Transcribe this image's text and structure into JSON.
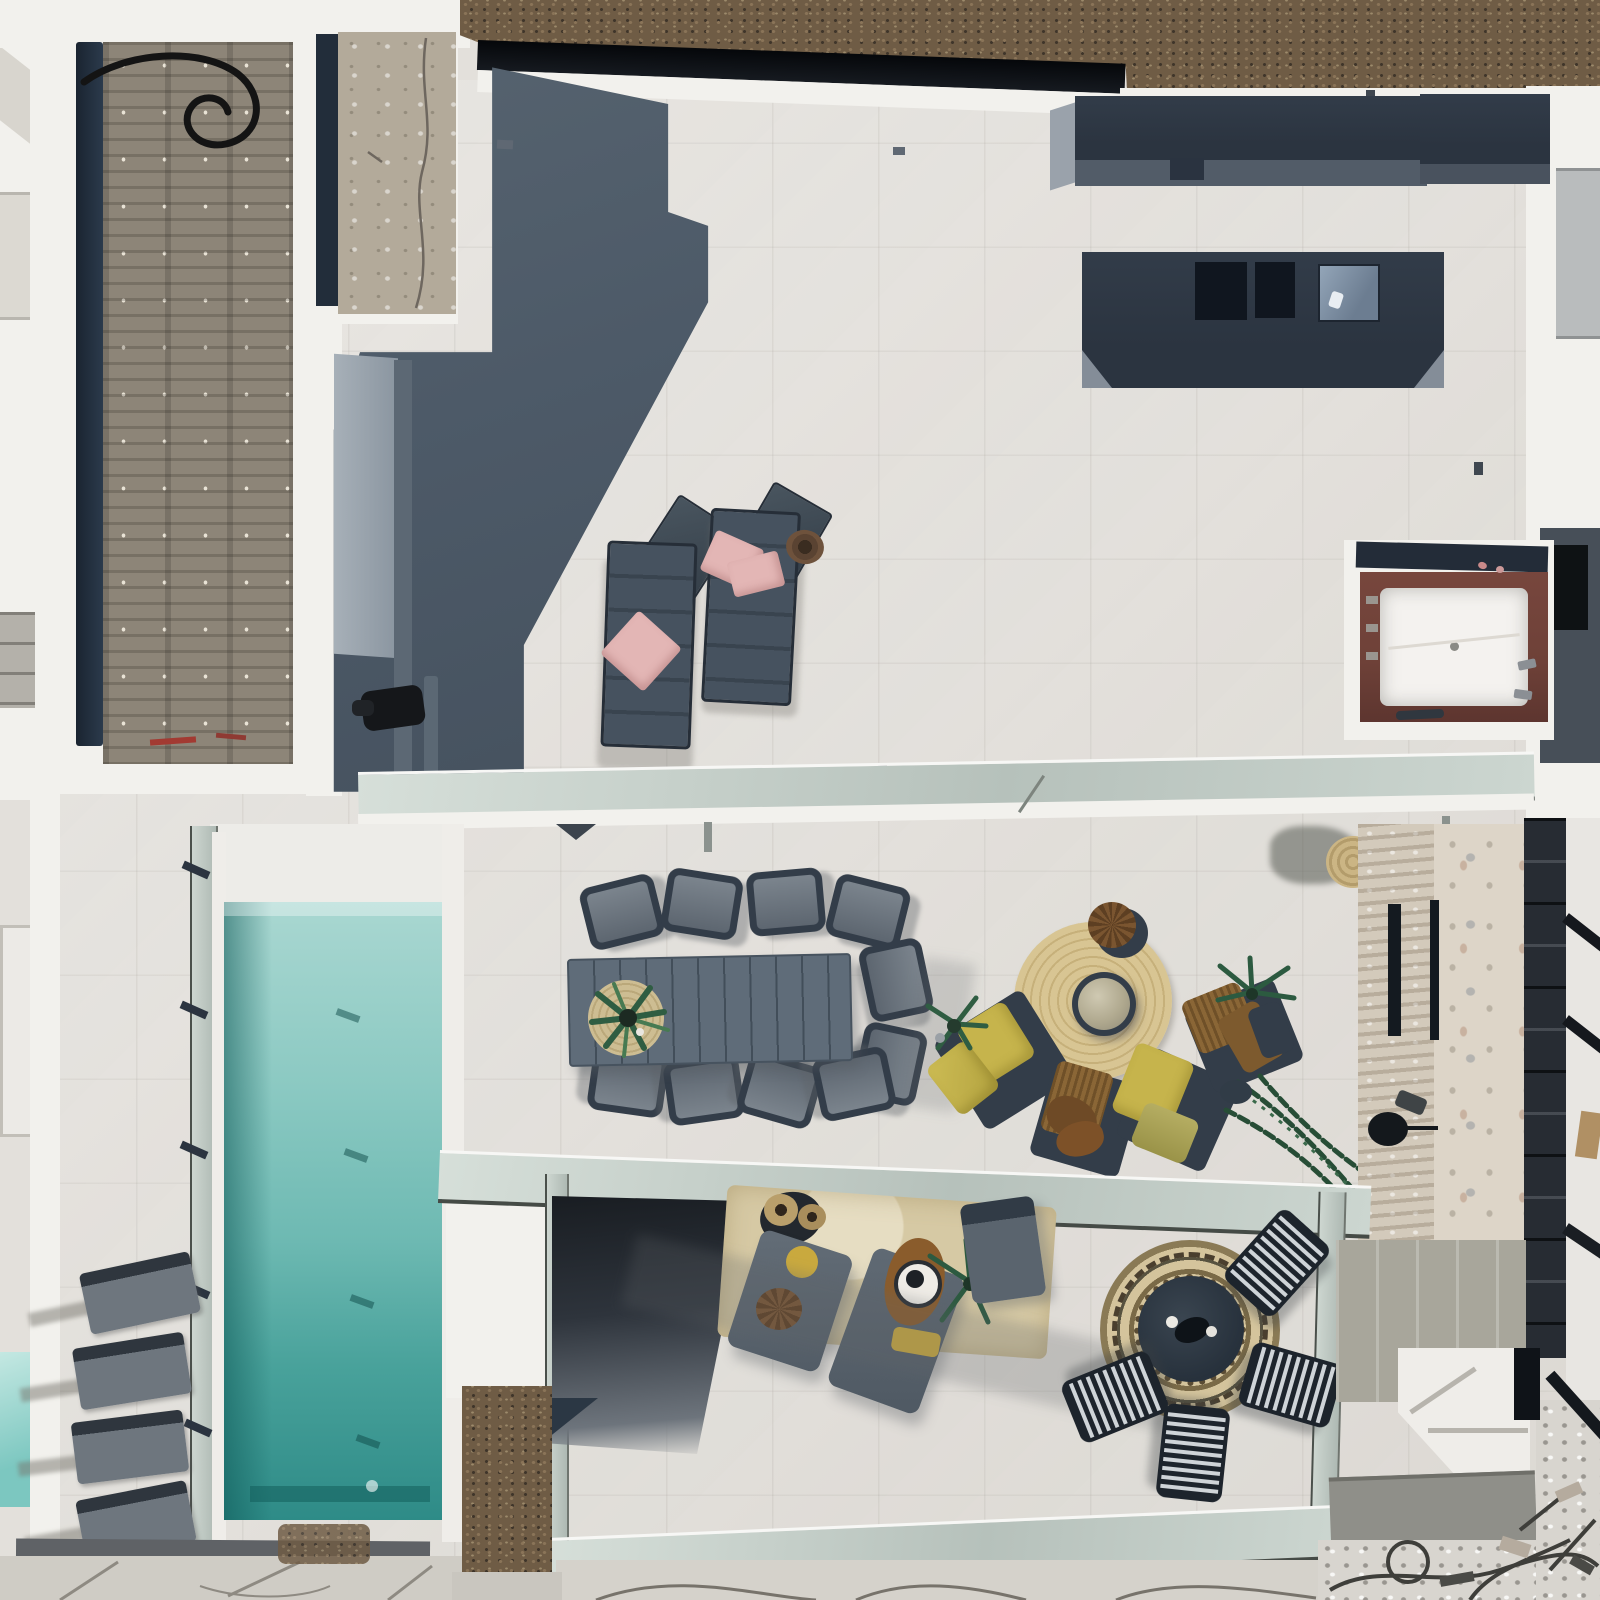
{
  "scene": {
    "type": "aerial-photo",
    "description": "Top-down drone view of a modern villa roof terrace: upper tiled deck with sun loungers and a wood-framed hot tub, dark roof boxes with skylights, a long turquoise lap pool with glass fencing, outdoor dining table, round jute rug lounge with yellow and wicker chairs, lower glass-walled patio with gray chaises and a mandala rug dining set, stone-clad wall with lamp, dark staircase and construction debris at the edges",
    "camera": "orthographic top-down",
    "colors": {
      "terrace-tile": "#e3e0db",
      "terrace-tile-shade": "#d7d4ce",
      "parapet-white": "#f2f1ed",
      "roof-felt": "#8d8578",
      "roof-felt-dark": "#6e675c",
      "navy-edge": "#212c3a",
      "concrete-beige": "#b3aa9a",
      "mulch": "#6f5c45",
      "mulch-dark": "#4e4232",
      "glass-band": "#c6d0ca",
      "glass-dark-rail": "#454b46",
      "slate-structure": "#4d5a68",
      "slate-light": "#95a0ab",
      "navy-box": "#2b3440",
      "navy-box-face": "#525c68",
      "skylight-blue": "#7d8fa3",
      "lounger-slate": "#414d5a",
      "pink-pillow": "#e3b6b5",
      "jacuzzi-wood": "#6e4138",
      "jacuzzi-tub": "#f4f2ef",
      "pool-light": "#a9d7d1",
      "pool-mid": "#6db9b2",
      "pool-deep": "#2e8b87",
      "pool-edge-dark": "#1f7a76",
      "gray-lounger": "#6e767e",
      "table-slat": "#5f6c79",
      "chair-navy": "#333d49",
      "jute": "#d8c593",
      "brass": "#b0a98f",
      "yellow-cushion": "#c6b44c",
      "wicker-brown": "#8a6636",
      "leather-brown": "#7a5330",
      "plant-green": "#3a6a4b",
      "plant-green-dark": "#274d36",
      "stone-wall": "#d3cabb",
      "stair-dark": "#272c33",
      "rug-beige": "#d6c9a4",
      "mandala-base": "#d4c49c",
      "mandala-dark": "#4a3f2e",
      "chair-slat-light": "#cfd4d8",
      "chair-slat-dark": "#1d242c",
      "debris-gray": "#d8d5cf",
      "paver-gray": "#cfccc5"
    },
    "objects": [
      {
        "name": "old-roof-panel",
        "label": "tar and gravel roof with black hose"
      },
      {
        "name": "concrete-panel",
        "label": "cracked concrete roof strip"
      },
      {
        "name": "mulch-ground",
        "label": "bark mulch ground beyond parapet"
      },
      {
        "name": "facade-glass-strip",
        "label": "black glazing band of facade"
      },
      {
        "name": "slate-structure",
        "label": "slate grey stair-core wall and its shadow"
      },
      {
        "name": "roof-box-long",
        "label": "long anthracite roof box"
      },
      {
        "name": "roof-box-skylights",
        "label": "anthracite roof box with two openings and a skylight"
      },
      {
        "name": "hot-tub",
        "label": "mahogany framed hot tub with white shell"
      },
      {
        "name": "sun-lounger",
        "label": "slate mesh sun loungers with pink cushions"
      },
      {
        "name": "glass-railing",
        "label": "frameless glass balustrades"
      },
      {
        "name": "lap-pool",
        "label": "turquoise lap pool with glass fence"
      },
      {
        "name": "pool-lounger",
        "label": "four grey poolside loungers"
      },
      {
        "name": "dining-set",
        "label": "slatted outdoor dining table with eight chairs and potted plant"
      },
      {
        "name": "jute-lounge",
        "label": "round jute rug, brass coffee table, yellow and wicker lounge chairs, palms"
      },
      {
        "name": "stone-wall",
        "label": "stacked stone wall with vents and lamp"
      },
      {
        "name": "lower-patio",
        "label": "lower glass patio with chaises, beige rug and plants"
      },
      {
        "name": "mandala-set",
        "label": "mandala rug with navy table and slatted chairs"
      },
      {
        "name": "staircase",
        "label": "dark external staircase"
      },
      {
        "name": "construction-debris",
        "label": "builders debris and cables"
      },
      {
        "name": "pavers",
        "label": "grey stone pavers"
      }
    ]
  }
}
